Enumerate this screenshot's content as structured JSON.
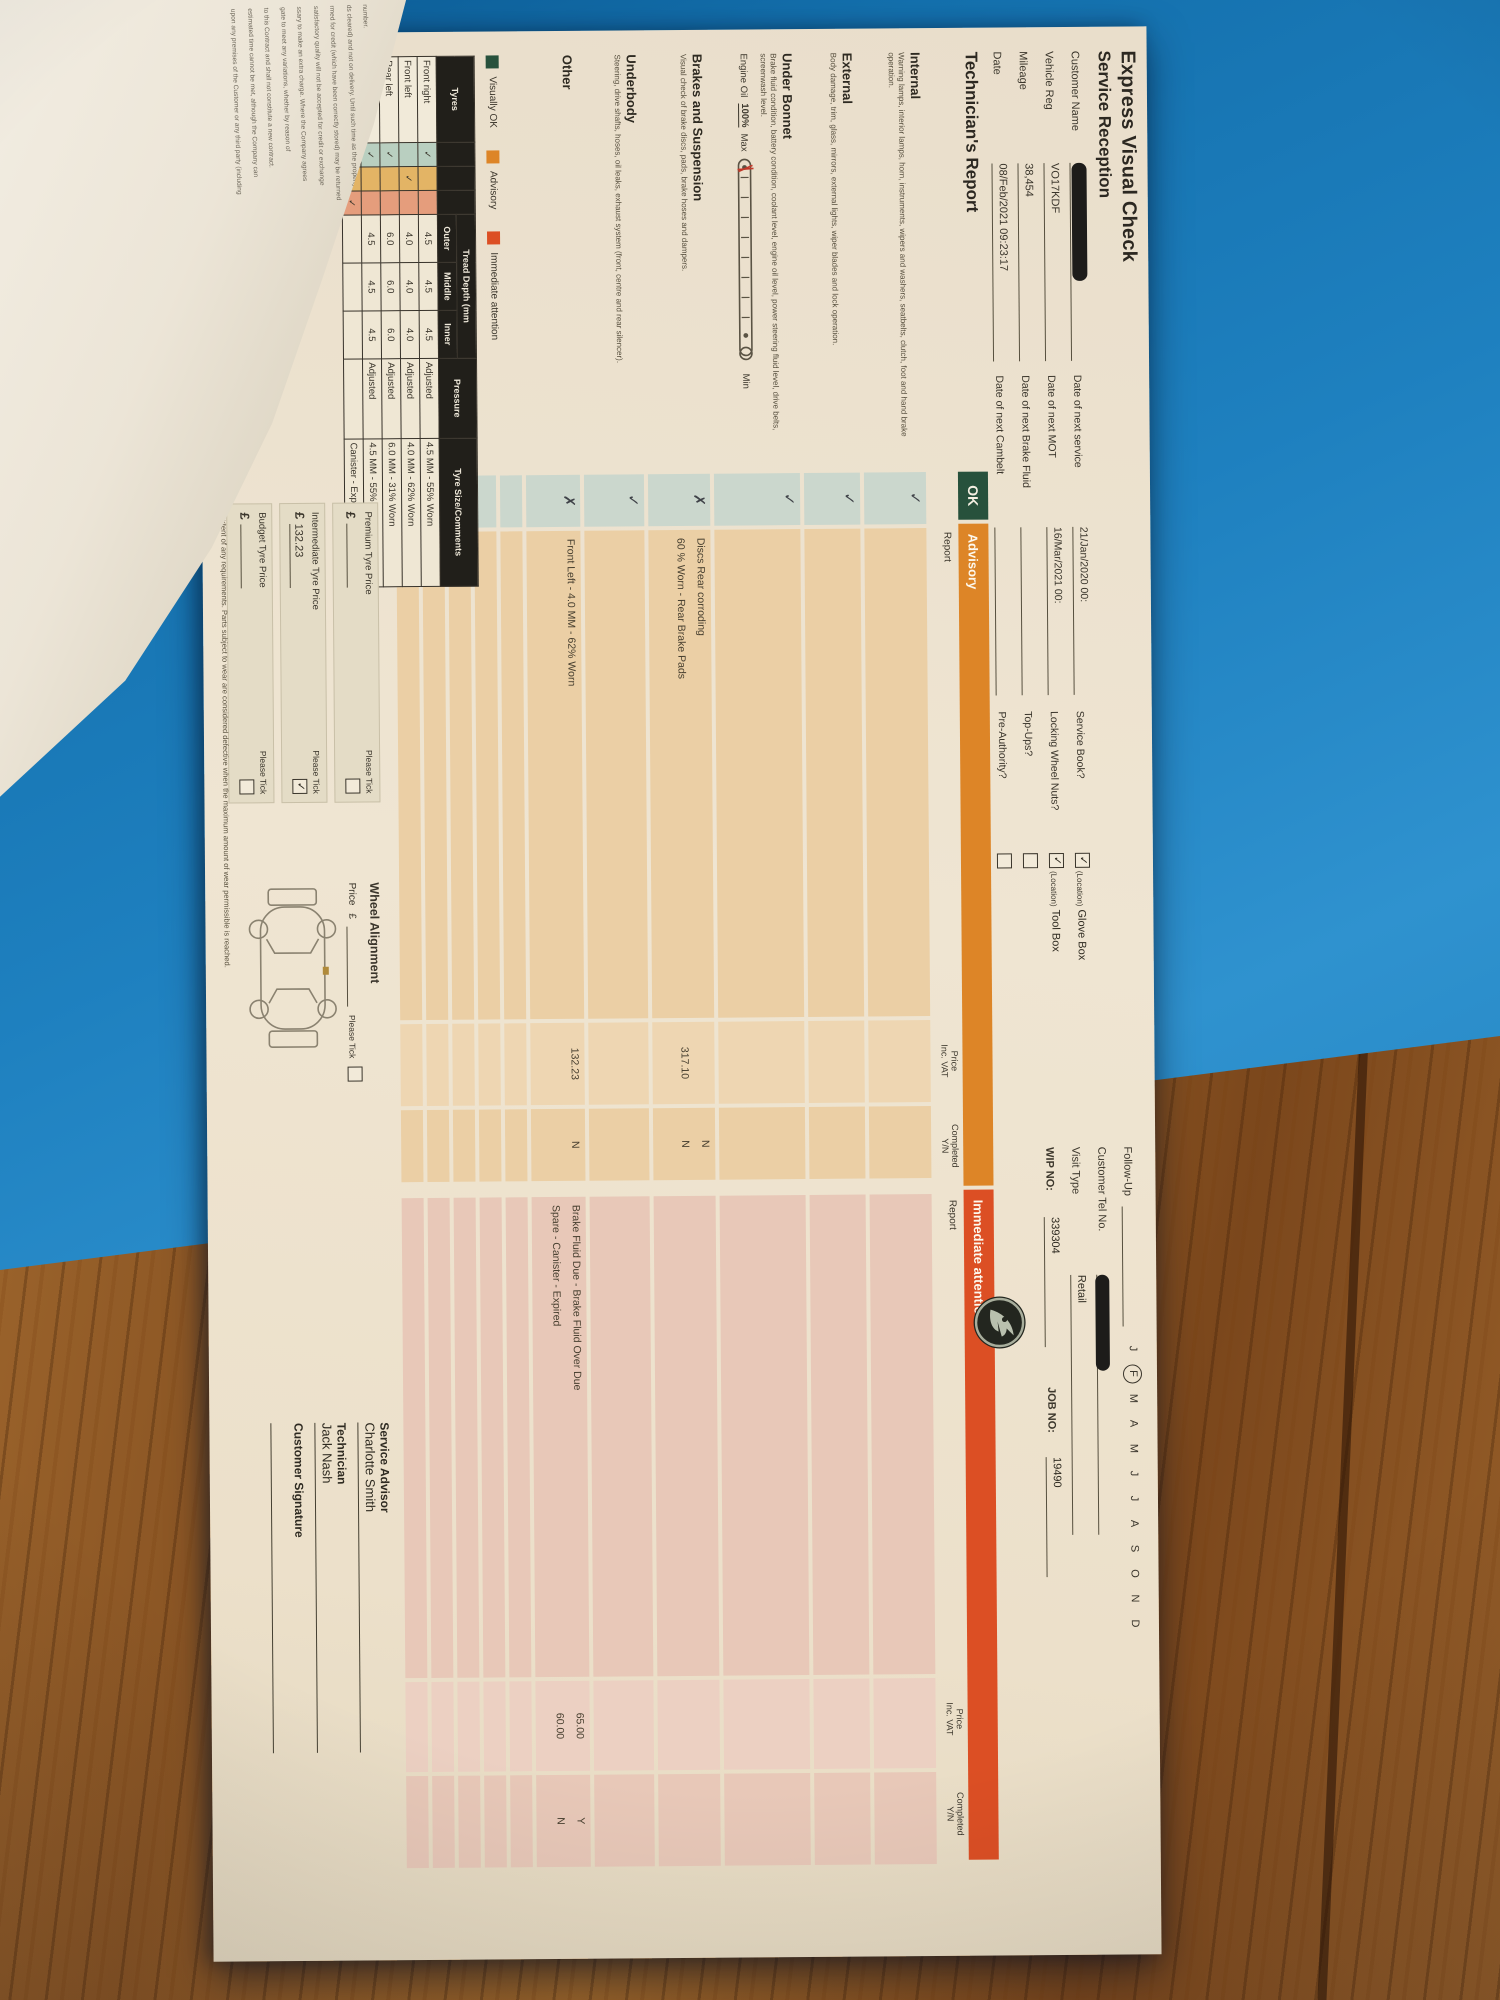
{
  "doc": {
    "title": "Express Visual Check",
    "subtitle": "Service Reception",
    "followup": {
      "label": "Follow-Up",
      "months": [
        "J",
        "F",
        "M",
        "A",
        "M",
        "J",
        "J",
        "A",
        "S",
        "O",
        "N",
        "D"
      ]
    },
    "info_primary": [
      {
        "label": "Customer Name",
        "value": ""
      },
      {
        "label": "Vehicle Reg",
        "value": "VO17KDF"
      },
      {
        "label": "Mileage",
        "value": "38,454"
      },
      {
        "label": "Date",
        "value": "08/Feb/2021 09:23:17"
      }
    ],
    "info_next_dates": [
      {
        "label": "Date of next service",
        "value": "21/Jan/2020 00:"
      },
      {
        "label": "Date of next MOT",
        "value": "16/Mar/2021 00:"
      },
      {
        "label": "Date of next Brake Fluid",
        "value": ""
      },
      {
        "label": "Date of next Cambelt",
        "value": ""
      }
    ],
    "info_checks": [
      {
        "label": "Service Book?",
        "tick": "✓",
        "location": "(Location)",
        "place": "Glove Box"
      },
      {
        "label": "Locking Wheel Nuts?",
        "tick": "✓",
        "location": "(Location)",
        "place": "Tool Box"
      },
      {
        "label": "Top-Ups?",
        "tick": "",
        "location": "",
        "place": ""
      },
      {
        "label": "Pre-Authority?",
        "tick": "",
        "location": "",
        "place": ""
      }
    ],
    "info_right": [
      {
        "label": "Customer Tel No.",
        "value": ""
      },
      {
        "label": "Visit Type",
        "value": "Retail"
      },
      {
        "label": "WIP NO:",
        "value": "339304",
        "label2": "JOB NO:",
        "value2": "19490"
      }
    ],
    "report": {
      "title": "Technician's Report",
      "headers": {
        "ok": "OK",
        "advisory": "Advisory",
        "immediate": "Immediate attention",
        "report": "Report",
        "price1": "Price",
        "price2": "Inc. VAT",
        "comp1": "Completed",
        "comp2": "Y/N"
      },
      "oil": {
        "label": "Engine Oil",
        "value": "100%",
        "max": "Max",
        "min": "Min"
      },
      "sections": [
        {
          "name": "Internal",
          "desc": "Warning lamps, interior lamps, horn, instruments, wipers and washers, seatbelts, clutch, foot and hand brake operation.",
          "mark": "✓"
        },
        {
          "name": "External",
          "desc": "Body damage, trim, glass, mirrors, external lights, wiper blades and lock operation.",
          "mark": "✓"
        },
        {
          "name": "Under Bonnet",
          "desc": "Brake fluid condition, battery condition, coolant level, engine oil level, power steering fluid level, drive belts, screenwash level.",
          "mark": "✓"
        },
        {
          "name": "Brakes and Suspension",
          "desc": "Visual check of brake discs, pads, brake hoses and dampers.",
          "mark": "✗",
          "adv": [
            {
              "text": "Discs Rear corroding",
              "price": "",
              "comp": "N"
            },
            {
              "text": "60 % Worn - Rear Brake Pads",
              "price": "317.10",
              "comp": "N"
            }
          ]
        },
        {
          "name": "Underbody",
          "desc": "Steering, drive shafts, hoses, oil leaks, exhaust system (front, centre and rear silencer).",
          "mark": "✓"
        },
        {
          "name": "Other",
          "desc": "",
          "mark": "✗",
          "adv": [
            {
              "text": "Front Left - 4.0 MM - 62% Worn",
              "price": "132.23",
              "comp": "N"
            }
          ],
          "imm": [
            {
              "text": "Brake Fluid Due - Brake Fluid Over Due",
              "price": "65.00",
              "comp": "Y"
            },
            {
              "text": "Spare - Canister - Expired",
              "price": "60.00",
              "comp": "N"
            }
          ]
        }
      ]
    },
    "legend": [
      {
        "label": "Visually OK"
      },
      {
        "label": "Advisory"
      },
      {
        "label": "Immediate attention"
      }
    ],
    "tyres": {
      "headers": {
        "col": "Tyres",
        "tread": "Tread Depth (mm",
        "outer": "Outer",
        "middle": "Middle",
        "inner": "Inner",
        "pressure": "Pressure",
        "size": "Tyre Size/Comments"
      },
      "rows": [
        {
          "position": "Front right",
          "s1": "✓",
          "s2": "",
          "s3": "",
          "outer": "4.5",
          "middle": "4.5",
          "inner": "4.5",
          "pressure": "Adjusted",
          "comment": "4.5 MM - 55% Worn"
        },
        {
          "position": "Front left",
          "s1": "",
          "s2": "✓",
          "s3": "",
          "outer": "4.0",
          "middle": "4.0",
          "inner": "4.0",
          "pressure": "Adjusted",
          "comment": "4.0 MM - 62% Worn"
        },
        {
          "position": "Rear left",
          "s1": "✓",
          "s2": "",
          "s3": "",
          "outer": "6.0",
          "middle": "6.0",
          "inner": "6.0",
          "pressure": "Adjusted",
          "comment": "6.0 MM - 31% Worn"
        },
        {
          "position": "Rear right",
          "s1": "✓",
          "s2": "",
          "s3": "",
          "outer": "4.5",
          "middle": "4.5",
          "inner": "4.5",
          "pressure": "Adjusted",
          "comment": "4.5 MM - 55% Worn"
        },
        {
          "position": "Spare",
          "s1": "",
          "s2": "",
          "s3": "✓",
          "outer": "",
          "middle": "",
          "inner": "",
          "pressure": "",
          "comment": "Canister - Expired"
        }
      ]
    },
    "prices": [
      {
        "label": "Premium Tyre Price",
        "cur": "£",
        "value": "",
        "tick_label": "Please Tick",
        "tick": ""
      },
      {
        "label": "Intermediate Tyre Price",
        "cur": "£",
        "value": "132.23",
        "tick_label": "Please Tick",
        "tick": "✓"
      },
      {
        "label": "Budget Tyre Price",
        "cur": "£",
        "value": "",
        "tick_label": "Please Tick",
        "tick": ""
      }
    ],
    "alignment": {
      "title": "Wheel Alignment",
      "price_label": "Price",
      "cur": "£",
      "tick_label": "Please Tick",
      "tick": ""
    },
    "signoff": {
      "advisor_label": "Service Advisor",
      "advisor_name": "Charlotte Smith",
      "tech_label": "Technician",
      "tech_name": "Jack Nash",
      "sig_label": "Customer Signature"
    },
    "footnote": "This report and any repair costs shown are the results of a visual inspection only. Further checks may be necessary to determine the full extent of any requirements. Parts subject to wear are considered defective when the maximum amount of wear permissible is reached."
  },
  "fold": {
    "lines": [
      {
        "t": "number."
      },
      {
        "t": "ds cleared) and not on delivery. Until such time as the property in the goods"
      },
      {
        "t": "rmed for credit (which have been correctly stored) may be returned"
      },
      {
        "t": "satisfactory quality will not be accepted for credit or exchange"
      },
      {
        "t": "ssary to make an extra charge. Where the Company agrees"
      },
      {
        "t": "gate to meet any variations, whether by reason of"
      },
      {
        "t": "to this Contract and shall not constitute a new contract."
      },
      {
        "t": "estimated time cannot be met, although the Company can"
      },
      {
        "t": "upon any premises of the Customer or any third party (including"
      }
    ]
  }
}
